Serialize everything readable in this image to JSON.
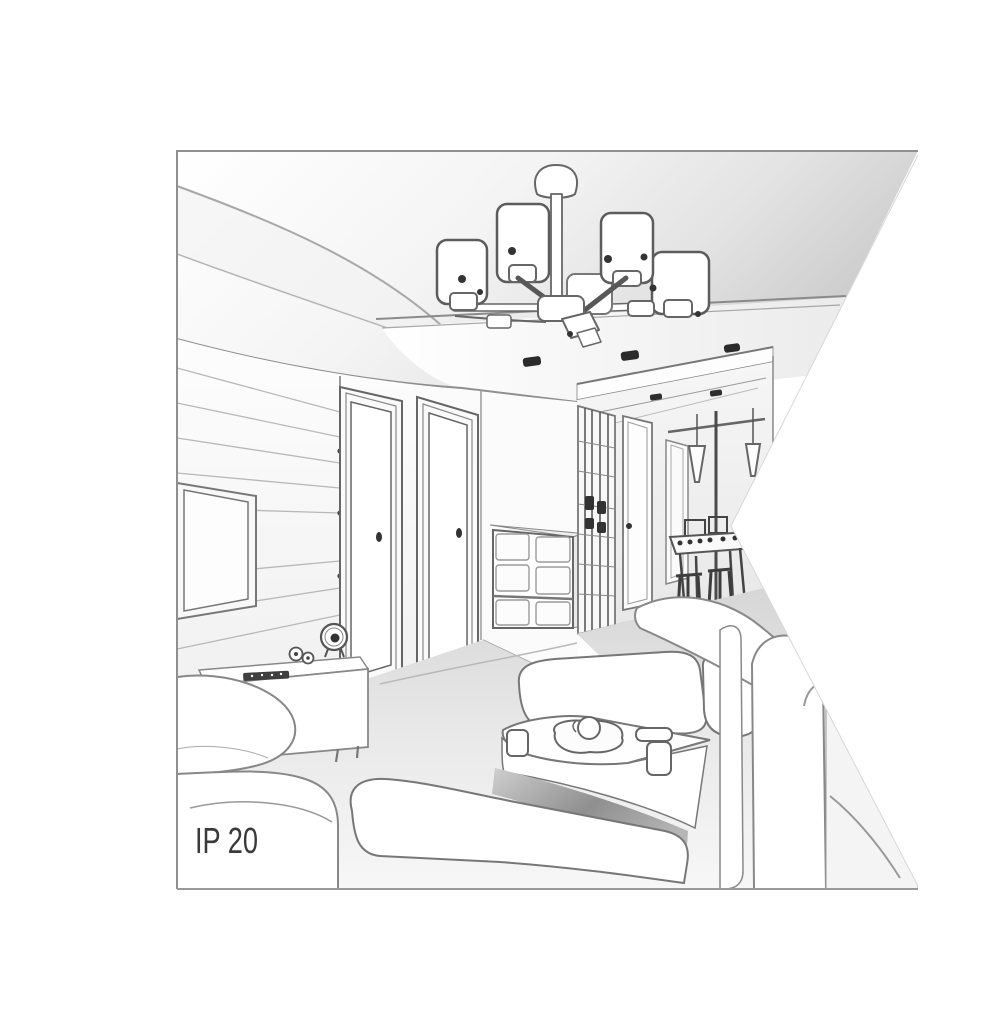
{
  "title": "Living room interior sketch",
  "badge": {
    "ip_rating": "IP 20"
  },
  "colors": {
    "background": "#ffffff",
    "border": "#8f8f8f",
    "line_dark": "#555555",
    "line_mid": "#888888",
    "line_light": "#b8b8b8",
    "fill_white": "#ffffff",
    "fill_light": "#f3f3f3",
    "ceiling_shade": "#cfcfcf",
    "seat_shadow": "#8f8f8f",
    "spotlight_dark": "#2b2b2b",
    "text": "#3a3a3a"
  },
  "objects": [
    "ceiling-chandelier",
    "suspended-ceiling-panel",
    "recessed-spotlights",
    "wall-tv",
    "media-console",
    "alarm-clock",
    "remote-control",
    "decor-figurines",
    "door-left",
    "door-right",
    "drawer-cabinet",
    "hallway-wardrobe",
    "hallway-door",
    "pendant-lights",
    "dining-table",
    "dining-chairs",
    "bar-stools",
    "coffee-table",
    "tea-tray",
    "sofa-left",
    "sofa-front",
    "sofa-center",
    "sofa-right"
  ]
}
